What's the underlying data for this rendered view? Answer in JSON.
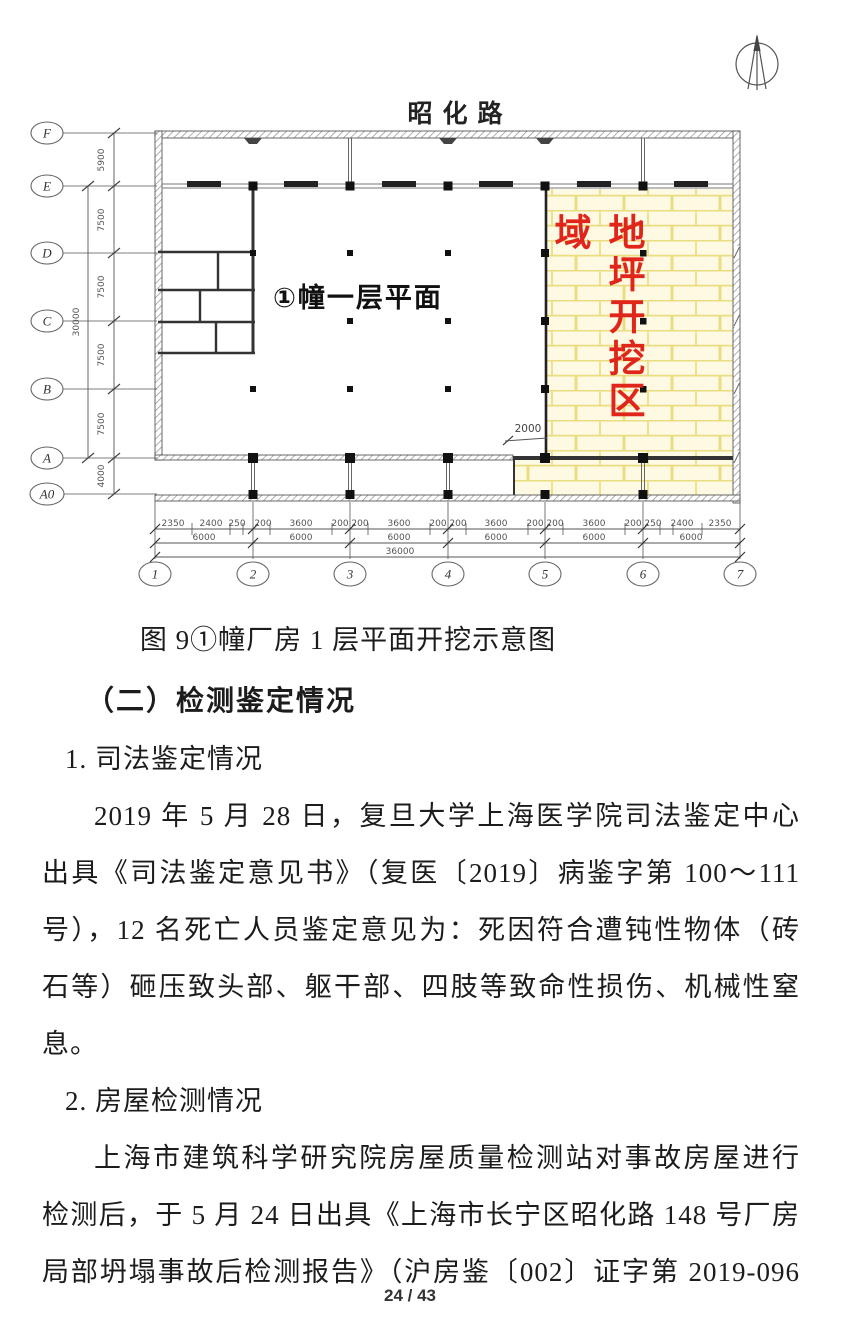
{
  "plan": {
    "road_label": "昭化路",
    "building_label": "①幢一层平面",
    "excavation_label": "地坪开挖区域",
    "excavation_extent_dim": "2000",
    "row_axes": [
      "F",
      "E",
      "D",
      "C",
      "B",
      "A",
      "A0"
    ],
    "col_axes": [
      "1",
      "2",
      "3",
      "4",
      "5",
      "6",
      "7"
    ],
    "left_dims": [
      "5900",
      "7500",
      "7500",
      "7500",
      "7500",
      "4000"
    ],
    "left_total_dim": "30000",
    "bottom_dims_detail": [
      "2350",
      "2400",
      "250",
      "200",
      "3600",
      "200",
      "200",
      "3600",
      "200",
      "200",
      "3600",
      "200",
      "200",
      "3600",
      "200",
      "250",
      "2400",
      "2350"
    ],
    "bottom_dims_bays": [
      "6000",
      "6000",
      "6000",
      "6000",
      "6000",
      "6000"
    ],
    "bottom_total_dim": "36000",
    "colors": {
      "excavation_fill": "#fdf9e3",
      "excavation_grid": "#eadd7f",
      "excavation_text": "#e0251a"
    }
  },
  "figure_caption": "图 9①幢厂房 1 层平面开挖示意图",
  "body": {
    "section_heading": "（二）检测鉴定情况",
    "item1_heading": "1. 司法鉴定情况",
    "p1_lines": [
      "2019 年 5 月 28 日，复旦大学上海医学院司法鉴定中心",
      "出具《司法鉴定意见书》（复医〔2019〕病鉴字第 100～111",
      "号），12 名死亡人员鉴定意见为：死因符合遭钝性物体（砖",
      "石等）砸压致头部、躯干部、四肢等致命性损伤、机械性窒",
      "息。"
    ],
    "item2_heading": "2. 房屋检测情况",
    "p2_lines": [
      "上海市建筑科学研究院房屋质量检测站对事故房屋进行",
      "检测后，于 5 月 24 日出具《上海市长宁区昭化路 148 号厂房",
      "局部坍塌事故后检测报告》（沪房鉴〔002〕证字第 2019-096"
    ]
  },
  "footer": {
    "page_number": "24 / 43"
  }
}
